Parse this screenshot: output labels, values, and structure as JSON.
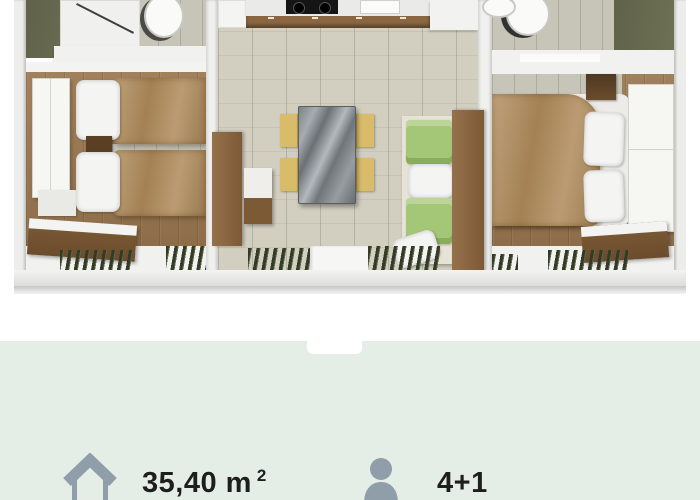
{
  "specs": {
    "area": {
      "icon": "house-icon",
      "value": "35,40 m",
      "sup": "2"
    },
    "capacity": {
      "icon": "person-icon",
      "value": "4+1"
    }
  },
  "floorplan": {
    "type": "3d-floorplan-render",
    "rooms": [
      {
        "name": "twin-bedroom",
        "position": "left",
        "furniture": [
          "wardrobe",
          "twin bed",
          "twin bed",
          "nightstand",
          "storage bench",
          "louvered window"
        ]
      },
      {
        "name": "bathroom",
        "position": "top-left",
        "furniture": [
          "shower",
          "toilet",
          "shelf"
        ]
      },
      {
        "name": "kitchen-living-room",
        "position": "center",
        "furniture": [
          "kitchenette",
          "cooktop",
          "sink",
          "dining table",
          "four chairs",
          "sofa with green cushions",
          "entry door"
        ]
      },
      {
        "name": "bathroom",
        "position": "top-right",
        "furniture": [
          "toilet",
          "washbasin",
          "counter"
        ]
      },
      {
        "name": "double-bedroom",
        "position": "right",
        "furniture": [
          "double bed",
          "wardrobe",
          "nightstand",
          "storage bench",
          "louvered window"
        ]
      }
    ]
  },
  "colors": {
    "page_background": "#ffffff",
    "specs_background": "#e5eee6",
    "icon_color": "#8f9ea9",
    "text_color": "#1e1e1e",
    "wood_floor": "#9a7750",
    "living_floor": "#d2cec0",
    "bathroom_floor": "#6b6d53",
    "blanket_brown": "#b08b5b",
    "cushion_green": "#a4c777",
    "chair_yellow": "#d8bc6a",
    "louver_green": "#333a25"
  }
}
